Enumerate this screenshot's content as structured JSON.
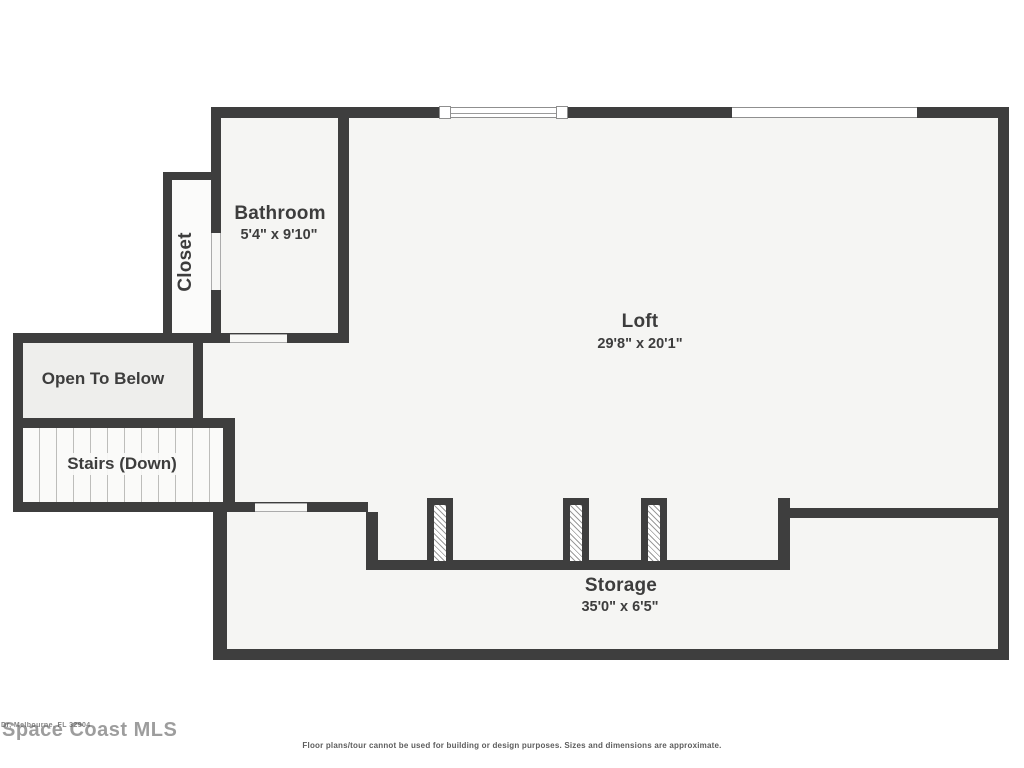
{
  "plan": {
    "rooms": {
      "bathroom": {
        "label": "Bathroom",
        "dimensions": "5'4\" x 9'10\""
      },
      "closet": {
        "label": "Closet"
      },
      "loft": {
        "label": "Loft",
        "dimensions": "29'8\" x 20'1\""
      },
      "open_to_below": {
        "label": "Open To Below"
      },
      "stairs": {
        "label": "Stairs (Down)"
      },
      "storage": {
        "label": "Storage",
        "dimensions": "35'0\" x 6'5\""
      }
    }
  },
  "watermark": {
    "brand": "Space Coast MLS",
    "small_text": "Dr, Melbourne, FL 32904"
  },
  "footer": {
    "disclaimer": "Floor plans/tour cannot be used for building or design purposes. Sizes and dimensions are approximate."
  },
  "colors": {
    "wall": "#3e3e3e",
    "interior": "#f5f5f3",
    "open_to_below_fill": "#eeeeec",
    "text": "#3d3d3d"
  }
}
